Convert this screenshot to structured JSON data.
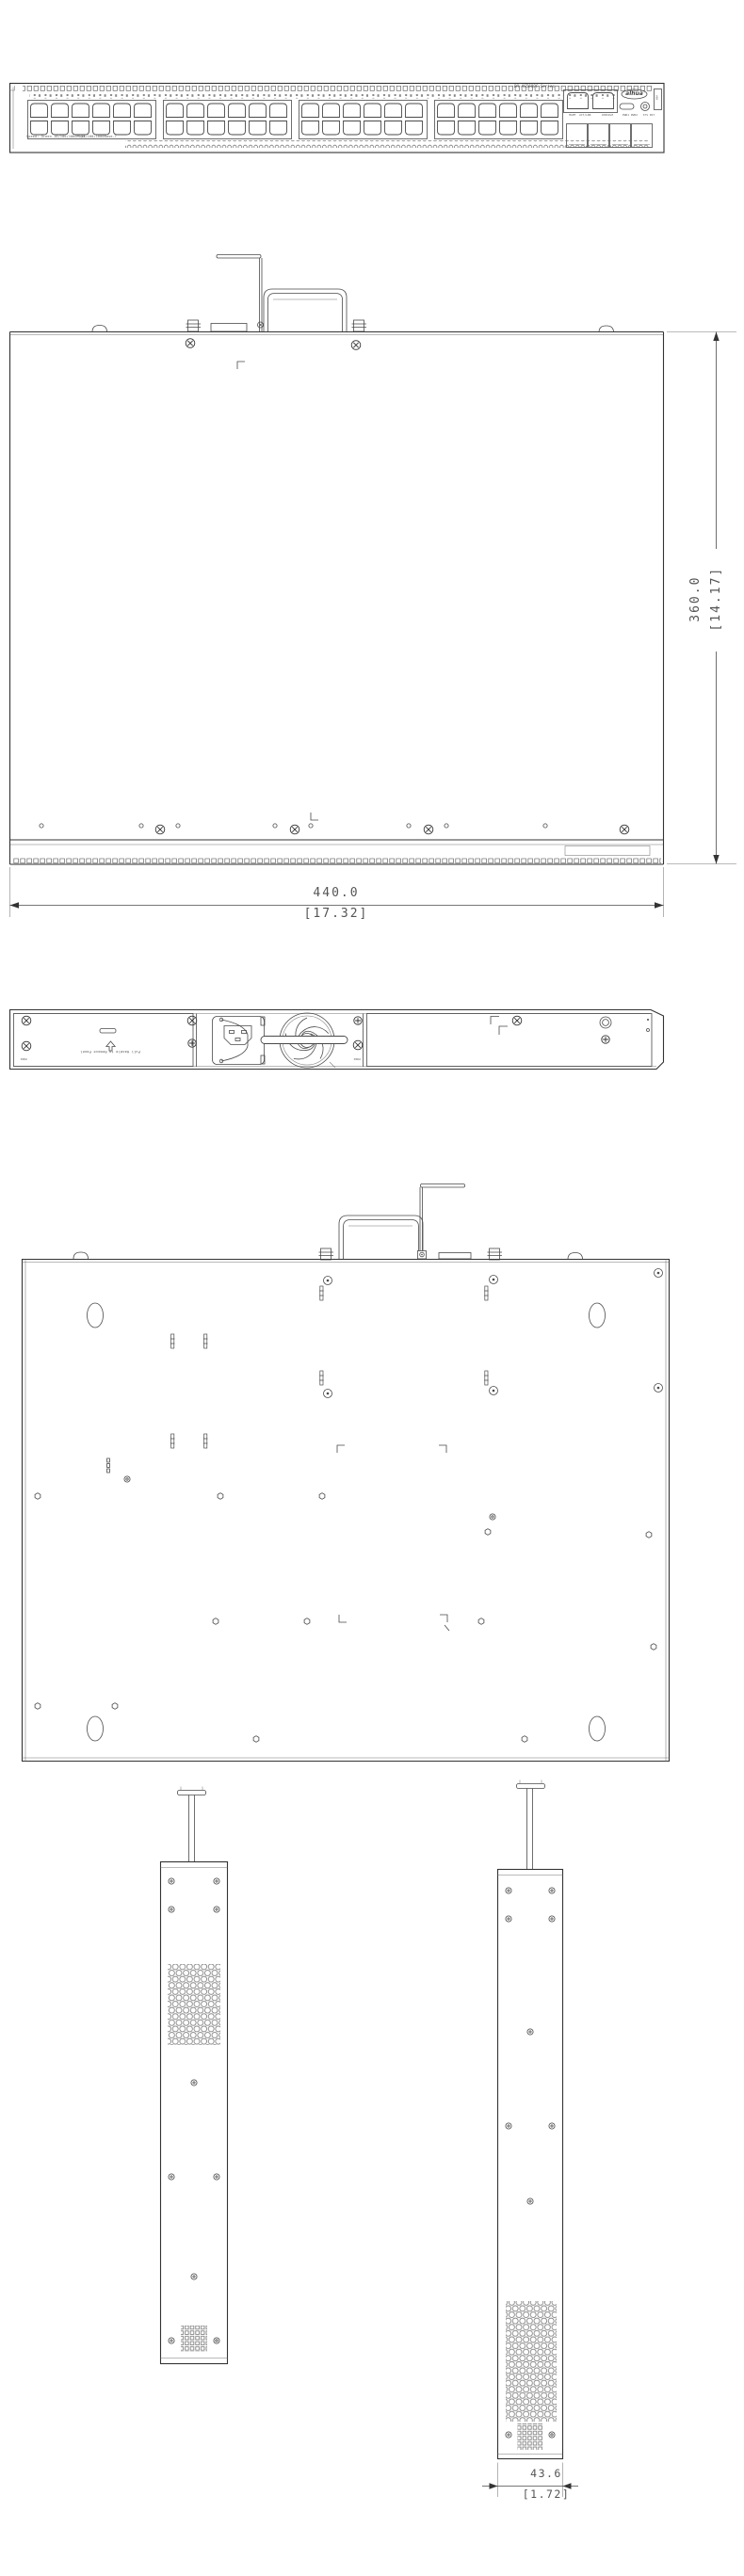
{
  "front": {
    "model_series": "DH-AS5600C Series",
    "brand_logo": "alhua",
    "usb_label": "USB",
    "mgmt_label": "MGMT  ACT/LNK",
    "console_label": "CONSOLE",
    "pwr_labels": "PWR1 PWR2",
    "sys_label": "SYS RST",
    "legend_speed": "Speed: Green 10/100/1000Mbps",
    "legend_ports": "10/100/1000Base-T"
  },
  "rear": {
    "panel_note": "Pull Handle to Remove Panel",
    "pwr1_label": "PWR1",
    "pwr2_label": "PWR2"
  },
  "dims": {
    "depth_mm": "360.0",
    "depth_in": "[14.17]",
    "width_mm": "440.0",
    "width_in": "[17.32]",
    "side_mm": "43.6",
    "side_in": "[1.72]"
  }
}
